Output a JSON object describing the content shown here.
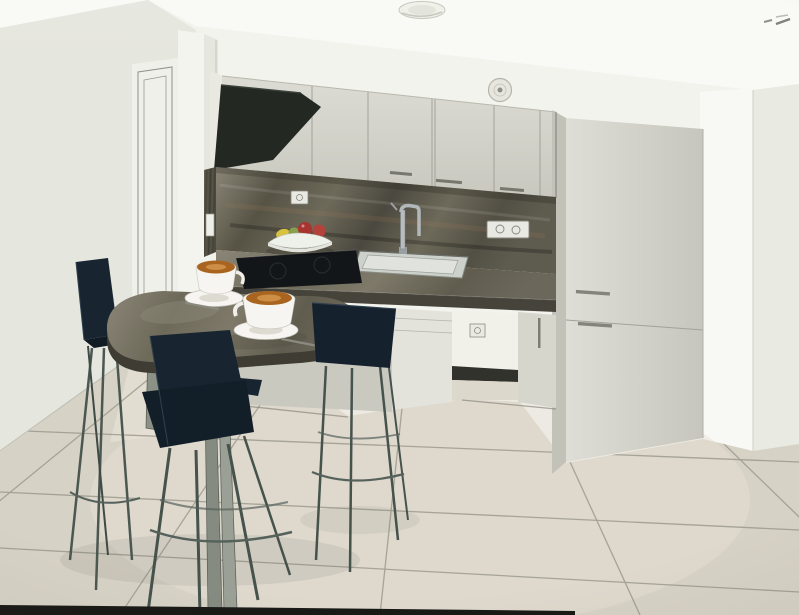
{
  "scene": {
    "kind": "photographed 3D interior rendering",
    "room": "small kitchen with breakfast bar, two coffee cups and navy bar stools",
    "objects": [
      "ceiling spotlight",
      "round wall vent",
      "interior door",
      "wall cabinets",
      "black angled range hood",
      "tall cabinet column",
      "dark stone backsplash",
      "power outlets",
      "light switch",
      "kitchen sink",
      "mixer tap",
      "black cooktop",
      "fruit bowl",
      "stone countertop",
      "stone breakfast bar",
      "coffee cups with saucers and spoons",
      "navy bar stools",
      "large tiled floor"
    ]
  },
  "palette": {
    "ceiling": "#f9f9f5",
    "left_wall": "#e5e6de",
    "back_wall": "#f3f3ee",
    "bright_wall": "#f8f8f4",
    "right_wall": "#e9eae2",
    "floor": "#d7d2c6",
    "floor_light": "#e6e1d4",
    "hall_floor": "#e2ddd1",
    "grout": "#8f8d81",
    "door": "#eef0e9",
    "jamb": "#f4f4ee",
    "cabinet_light": "#d7d7ce",
    "cabinet_shade": "#c2c2b9",
    "marble_dark": "#4b483f",
    "marble_mid": "#6e6a5a",
    "marble_light": "#8b8677",
    "hood": "#232823",
    "cooktop": "#131619",
    "table_edge": "#3f3d33",
    "stool_navy": "#18242f",
    "stool_navy_dark": "#15212c",
    "metal_leg": "#4b5751",
    "metal_post": "#8b9186",
    "china": "#f6f5f1",
    "saucer_inner": "#dddbd1",
    "coffee": "#a9651f",
    "coffee_cream": "#d2964c",
    "niche": "#f1f1ea",
    "kick": "#32322c",
    "socket": "#e9e9e3",
    "photo_edge": "#181815",
    "fruit_red": "#a83430",
    "fruit_red2": "#b2423a",
    "fruit_yellow": "#d8c23f",
    "fruit_green": "#87a04e",
    "bowl": "#eef0ea"
  }
}
